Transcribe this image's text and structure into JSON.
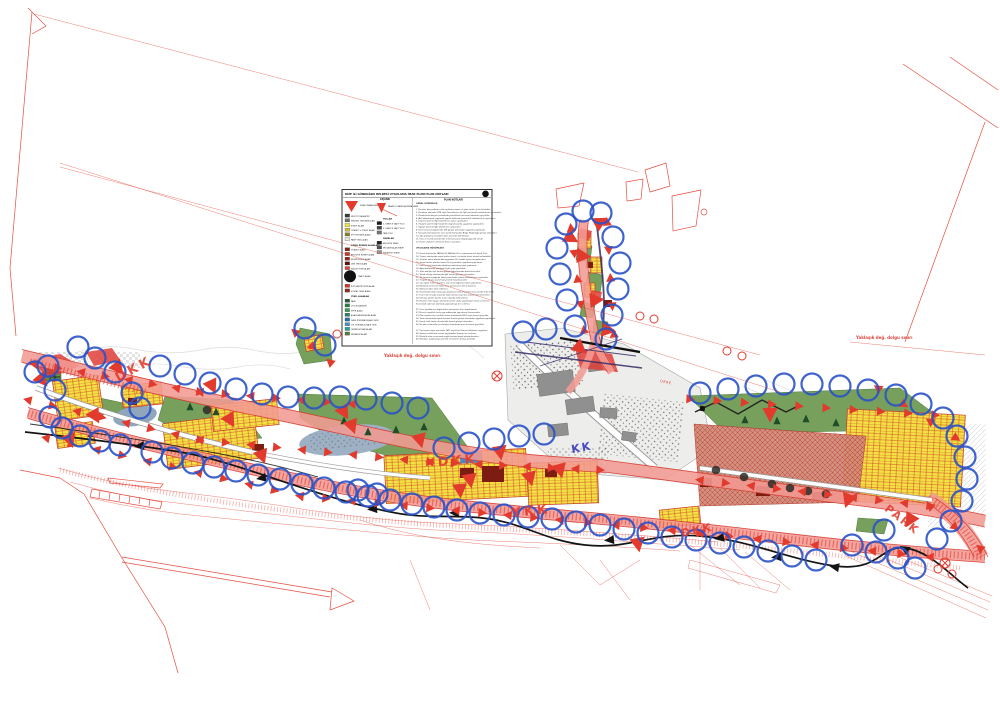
{
  "title": "RİZE İLİ GÜNDOĞDU BELDESİ UYGULAMA İMAR PLANI PLAN NOTLARI",
  "colors": {
    "boundary_red": "#e23b2e",
    "corridor_pink": "#f29a93",
    "parcel_yellow": "#f2e243",
    "park_green": "#76a05c",
    "circle_blue": "#2a52c8",
    "brick": "#cf8a79",
    "water": "#9db0c4",
    "ink": "#141414"
  },
  "legend": {
    "title": "RİZE İLİ GÜNDOĞDU BELDESİ UYGULAMA İMAR PLANI PLAN NOTLARI",
    "lejand_label": "LEJAND",
    "notes_title": "PLAN NOTLARI",
    "col1": [
      {
        "sym": "tri",
        "c": "#e23b2e",
        "t": "PLAN ONAMA SINIRI"
      },
      {
        "sym": "sw",
        "c": "#3a3a3a",
        "t": "MEVCUT KADASTRO"
      },
      {
        "sym": "sw",
        "c": "#6e6e6e",
        "t": "KENTSEL YERLEŞİK ALAN"
      },
      {
        "sym": "sw",
        "c": "#f2e243",
        "t": "KONUT ALANI"
      },
      {
        "sym": "sw",
        "c": "#cdbb3e",
        "t": "TİCARET + KONUT ALANI"
      },
      {
        "sym": "sw",
        "c": "#8a7f2f",
        "t": "KÖY YERLEŞİK ALANI"
      },
      {
        "sym": "sw",
        "c": "#e8e6da",
        "t": "PASİF YEŞİL ALAN"
      },
      {
        "sym": "hdr",
        "c": "",
        "t": "KAMU KURUM ALANLARI"
      },
      {
        "sym": "sw",
        "c": "#8c1d12",
        "t": "TİCARET ALANI"
      },
      {
        "sym": "sw",
        "c": "#c0392b",
        "t": "BELEDİYE HİZMET ALANI"
      },
      {
        "sym": "sw",
        "c": "#93271e",
        "t": "RESMİ KURUM ALANI"
      },
      {
        "sym": "sw",
        "c": "#5b1207",
        "t": "DİNİ TESİS ALANI"
      },
      {
        "sym": "sw",
        "c": "#d04a3a",
        "t": "SAĞLIK TESİS ALANI"
      },
      {
        "sym": "circle",
        "c": "#111111",
        "t": "TRAFO ALANI"
      },
      {
        "sym": "sw",
        "c": "#d3372c",
        "t": "İLKÖĞRETİM TESİS ALANI"
      },
      {
        "sym": "sw",
        "c": "#8f2a20",
        "t": "SOSYAL TESİS ALANI"
      },
      {
        "sym": "hdr",
        "c": "",
        "t": "YEŞİL ALANLAR"
      },
      {
        "sym": "sw",
        "c": "#1e5c34",
        "t": "PARK"
      },
      {
        "sym": "sw",
        "c": "#2e7d46",
        "t": "ÇOCUK BAHÇESİ"
      },
      {
        "sym": "sw",
        "c": "#3f9a58",
        "t": "SPOR ALANI"
      },
      {
        "sym": "sw",
        "c": "#2a7f71",
        "t": "AĞAÇLANDIRILACAK ALAN"
      },
      {
        "sym": "sw",
        "c": "#1f6fae",
        "t": "DERE KORUMA KUŞAĞI (DKK)"
      },
      {
        "sym": "sw",
        "c": "#4a90c4",
        "t": "YOL KORUMA KUŞAĞI (YKK)"
      },
      {
        "sym": "sw",
        "c": "#2aa198",
        "t": "TEKNİK ALTYAPI ALANI"
      },
      {
        "sym": "sw",
        "c": "#577d35",
        "t": "MEZARLIK ALANI"
      }
    ],
    "col2": [
      {
        "sym": "funnel",
        "c": "#e23b2e",
        "t": "KARAYOLU KAMULAŞTIRMA SINIRI"
      },
      {
        "sym": "hdr",
        "c": "",
        "t": "YOLLAR"
      },
      {
        "sym": "sw",
        "c": "#1a1a1a",
        "t": "1. DERECE TAŞIT YOLU"
      },
      {
        "sym": "sw",
        "c": "#4a4a4a",
        "t": "2. DERECE TAŞIT YOLU"
      },
      {
        "sym": "sw",
        "c": "#777777",
        "t": "YAYA YOLU"
      },
      {
        "sym": "hdr",
        "c": "",
        "t": "SINIRLAR"
      },
      {
        "sym": "sw",
        "c": "#222222",
        "t": "BELEDİYE SINIRI"
      },
      {
        "sym": "sw",
        "c": "#555555",
        "t": "MÜCAVİR ALAN SINIRI"
      },
      {
        "sym": "sw",
        "c": "#999999",
        "t": "KADASTRO SINIRI"
      }
    ],
    "notes": [
      "GENEL HÜKÜMLER",
      "",
      "1. Bu plan; plan paftaları, plan açıklama raporu ve plan notları ile bir bütündür.",
      "2. Planlama alanında 3194 sayılı İmar Kanunu ile ilgili yönetmelik hükümlerine uyulacaktır.",
      "3. Planda belirtilmeyen hususlarda yürürlükteki mevzuat hükümleri geçerlidir.",
      "4. Afet bölgelerinde yapılacak yapılar hakkında yönetmelik hükümlerine uyulacaktır.",
      "5. Deprem yönetmeliği hükümlerine aynen uyulacaktır.",
      "6. Otopark yönetmeliği hükümleri doğrultusunda uygulama yapılacaktır.",
      "7. Sığınak yönetmeliği hükümlerine uyulacaktır.",
      "8. Dere koruma kuşaklarında DSİ görüşü alınmadan uygulama yapılamaz.",
      "9. Karayolu kamulaştırma sınırı içinde Karayolları Bölge Müdürlüğü görüşü alınacaktır.",
      "10. Yapı yaklaşma mesafeleri plan üzerinde belirtilmiştir.",
      "11. İfraz ve tevhid işlemlerinde minimum parsel büyüklüğü 250 m2'dir.",
      "12. Parsel cepheleri minimum 8.00 m olacaktır.",
      "",
      "UYGULAMA HÜKÜMLERİ",
      "",
      "13. Konut alanlarında TAKS=0.30 KAKS=0.90 ve maksimum kat adedi 3'tür.",
      "14. Ticaret alanlarında zemin katlar ticaret, üst katlar konut olarak kullanılabilir.",
      "15. Gelişme konut alanlarında uygulama 18. madde uyarınca yapılacaktır.",
      "16. Sosyal donatı alanları kamu eline geçmeden uygulama yapılamaz.",
      "17. Park ve yeşil alanlarda sökülemez-takılamaz yapı yapılamaz.",
      "18. Ağaçlandırılacak alanlarda hiçbir yapı yapılamaz.",
      "19. Trafo alanları ilgili kurum görüşü doğrultusunda düzenlenecektir.",
      "20. Teknik altyapı alanlarında ilgili kurum görüşleri alınacaktır.",
      "21. Yol koruma kuşağında kalan parsellerde çekme mesafelerine uyulacaktır.",
      "22. Otopark ihtiyacı parsel bünyesinde karşılanacaktır.",
      "23. Çatı eğimi %33'ü geçemez. Çatı arası bağımsız bölüm yapılamaz.",
      "24. Binalarda zemin kat taban kotu yol kotunun altına düşemez.",
      "25. Bodrum katlar iskan edilemez.",
      "26. Parsellerde birden fazla yapı yapılması halinde yapılar arası mesafe 6.00 m'dir.",
      "27. İmar hattı ile yapı arasında kalan alanlar yeşil alan olarak düzenlenecektir.",
      "28. Kamuya ayrılan alanlar amacı dışında kullanılamaz.",
      "29. Heyelan riski taşıyan alanlarda zemin etüdü yapılmadan ruhsat verilemez.",
      "30. Jeolojik sakıncalı alanlarda yapılaşmaya izin verilmez.",
      "",
      "31. Dere yataklarının doğal halleri korunacak, üzeri kapatılamaz.",
      "32. Mevcut teşekkül etmiş yapı adalarında yapı düzeni korunacaktır.",
      "33. Plan onama sınırı içindeki orman alanlarında 6831 sayılı kanun geçerlidir.",
      "34. Tarım alanlarında toprak koruma kurulu görüşü alınmadan uygulama yapılamaz.",
      "35. Enerji nakil hatları altında ilgili kurum görüşü alınacaktır.",
      "36. Bu plan notlarında yer almayan hususlarda meri mevzuat geçerlidir.",
      "",
      "37. Kıyı kenar çizgisi içerisinde 3621 sayılı Kıyı Kanunu hükümleri uygulanır.",
      "38. Sanayi tesislerinde arıtma yapılmadan deşarja izin verilmez.",
      "39. Mezarlık alanı çevresinde sağlık koruma bandı oluşturulacaktır.",
      "40. Belediye, uygulamaya yönelik ek kararlar almaya yetkilidir."
    ]
  },
  "map": {
    "labels": [
      {
        "t": "DKK",
        "x": 118,
        "y": 382,
        "r": -28,
        "s": 13,
        "c": "#e23b2e",
        "ls": 3,
        "b": 1
      },
      {
        "t": "DKK",
        "x": 438,
        "y": 466,
        "r": -4,
        "s": 13,
        "c": "#e23b2e",
        "ls": 3,
        "b": 1
      },
      {
        "t": "DKK",
        "x": 682,
        "y": 537,
        "r": -12,
        "s": 11,
        "c": "#e23b2e",
        "ls": 2,
        "b": 1
      },
      {
        "t": "YKK",
        "x": 512,
        "y": 517,
        "r": -6,
        "s": 13,
        "c": "#e23b2e",
        "ls": 3,
        "b": 1
      },
      {
        "t": "KK",
        "x": 572,
        "y": 453,
        "r": -10,
        "s": 11,
        "c": "#3333bb",
        "ls": 2,
        "b": 1
      },
      {
        "t": "PARK",
        "x": 884,
        "y": 510,
        "r": 38,
        "s": 11,
        "c": "#e23b2e",
        "ls": 2,
        "b": 1
      },
      {
        "t": "Yaklaşık değ. dolgu sınırı",
        "x": 384,
        "y": 357,
        "r": 0,
        "s": 4,
        "c": "#d42a20",
        "ls": 0,
        "b": 1
      },
      {
        "t": "Yaklaşık değ. dolgu sınırı",
        "x": 856,
        "y": 339,
        "r": 0,
        "s": 4,
        "c": "#d42a20",
        "ls": 0,
        "b": 1
      },
      {
        "t": "DERE",
        "x": 660,
        "y": 382,
        "r": 12,
        "s": 3.5,
        "c": "#d42a20",
        "ls": 0.5,
        "b": 0
      }
    ],
    "blue_circles": [
      [
        78,
        347
      ],
      [
        48,
        366
      ],
      [
        95,
        358
      ],
      [
        35,
        372
      ],
      [
        55,
        390
      ],
      [
        50,
        417
      ],
      [
        62,
        428
      ],
      [
        80,
        436
      ],
      [
        100,
        441
      ],
      [
        120,
        445
      ],
      [
        132,
        393
      ],
      [
        115,
        372
      ],
      [
        140,
        408
      ],
      [
        152,
        452
      ],
      [
        172,
        458
      ],
      [
        193,
        463
      ],
      [
        214,
        467
      ],
      [
        236,
        471
      ],
      [
        258,
        475
      ],
      [
        280,
        479
      ],
      [
        302,
        484
      ],
      [
        324,
        488
      ],
      [
        346,
        492
      ],
      [
        368,
        496
      ],
      [
        390,
        500
      ],
      [
        412,
        504
      ],
      [
        434,
        507
      ],
      [
        457,
        510
      ],
      [
        480,
        513
      ],
      [
        504,
        515
      ],
      [
        528,
        517
      ],
      [
        552,
        519
      ],
      [
        576,
        522
      ],
      [
        600,
        525
      ],
      [
        624,
        529
      ],
      [
        648,
        533
      ],
      [
        672,
        537
      ],
      [
        696,
        540
      ],
      [
        160,
        366
      ],
      [
        185,
        374
      ],
      [
        210,
        383
      ],
      [
        236,
        389
      ],
      [
        262,
        394
      ],
      [
        288,
        397
      ],
      [
        314,
        398
      ],
      [
        340,
        397
      ],
      [
        366,
        399
      ],
      [
        392,
        403
      ],
      [
        418,
        408
      ],
      [
        444,
        448
      ],
      [
        469,
        443
      ],
      [
        494,
        439
      ],
      [
        519,
        436
      ],
      [
        544,
        434
      ],
      [
        523,
        332
      ],
      [
        546,
        329
      ],
      [
        358,
        490
      ],
      [
        377,
        494
      ],
      [
        305,
        328
      ],
      [
        325,
        345
      ],
      [
        566,
        224
      ],
      [
        557,
        248
      ],
      [
        560,
        274
      ],
      [
        567,
        300
      ],
      [
        575,
        326
      ],
      [
        601,
        213
      ],
      [
        613,
        237
      ],
      [
        620,
        263
      ],
      [
        618,
        289
      ],
      [
        612,
        315
      ],
      [
        606,
        339
      ],
      [
        583,
        211
      ],
      [
        700,
        393
      ],
      [
        728,
        389
      ],
      [
        756,
        386
      ],
      [
        784,
        384
      ],
      [
        812,
        384
      ],
      [
        840,
        386
      ],
      [
        868,
        390
      ],
      [
        896,
        395
      ],
      [
        921,
        404
      ],
      [
        943,
        418
      ],
      [
        957,
        436
      ],
      [
        965,
        457
      ],
      [
        967,
        479
      ],
      [
        962,
        501
      ],
      [
        951,
        521
      ],
      [
        937,
        539
      ],
      [
        852,
        545
      ],
      [
        876,
        552
      ],
      [
        898,
        558
      ],
      [
        915,
        568
      ],
      [
        884,
        530
      ],
      [
        720,
        543
      ],
      [
        744,
        547
      ],
      [
        768,
        551
      ],
      [
        792,
        556
      ],
      [
        816,
        560
      ]
    ],
    "triangle_chains": [
      {
        "f": [
          34,
          364
        ],
        "t": [
          200,
          392
        ],
        "n": 8,
        "s": "a"
      },
      {
        "f": [
          200,
          392
        ],
        "t": [
          352,
          404
        ],
        "n": 7,
        "s": "a"
      },
      {
        "f": [
          28,
          400
        ],
        "t": [
          200,
          440
        ],
        "n": 8,
        "s": "a"
      },
      {
        "f": [
          200,
          440
        ],
        "t": [
          430,
          462
        ],
        "n": 10,
        "s": "a"
      },
      {
        "f": [
          430,
          462
        ],
        "t": [
          600,
          470
        ],
        "n": 8,
        "s": "a"
      },
      {
        "f": [
          46,
          438
        ],
        "t": [
          300,
          496
        ],
        "n": 11,
        "s": "a"
      },
      {
        "f": [
          300,
          496
        ],
        "t": [
          560,
          520
        ],
        "n": 11,
        "s": "a"
      },
      {
        "f": [
          560,
          520
        ],
        "t": [
          700,
          533
        ],
        "n": 6,
        "s": "a"
      },
      {
        "f": [
          700,
          533
        ],
        "t": [
          930,
          557
        ],
        "n": 9,
        "s": "a"
      },
      {
        "f": [
          690,
          399
        ],
        "t": [
          935,
          415
        ],
        "n": 10,
        "s": 1
      },
      {
        "f": [
          700,
          480
        ],
        "t": [
          930,
          506
        ],
        "n": 10,
        "s": "a"
      },
      {
        "f": [
          930,
          506
        ],
        "t": [
          980,
          548
        ],
        "n": 3,
        "s": "a"
      },
      {
        "f": [
          571,
          228
        ],
        "t": [
          584,
          330
        ],
        "n": 5,
        "s": "a"
      },
      {
        "f": [
          607,
          222
        ],
        "t": [
          614,
          334
        ],
        "n": 5,
        "s": "a"
      },
      {
        "f": [
          878,
          388
        ],
        "t": [
          956,
          438
        ],
        "n": 4,
        "s": "a"
      },
      {
        "f": [
          295,
          332
        ],
        "t": [
          330,
          362
        ],
        "n": 3,
        "s": "a"
      }
    ],
    "big_triangles": [
      [
        212,
        386,
        155
      ],
      [
        344,
        412,
        150
      ],
      [
        352,
        426,
        160
      ],
      [
        470,
        480,
        170
      ],
      [
        583,
        256,
        95
      ],
      [
        596,
        300,
        85
      ],
      [
        460,
        490,
        175
      ],
      [
        530,
        478,
        165
      ],
      [
        638,
        544,
        170
      ],
      [
        118,
        368,
        140
      ],
      [
        95,
        416,
        150
      ],
      [
        262,
        456,
        160
      ],
      [
        770,
        414,
        180
      ],
      [
        848,
        500,
        200
      ],
      [
        600,
        222,
        60
      ],
      [
        571,
        238,
        120
      ],
      [
        608,
        330,
        100
      ],
      [
        580,
        348,
        130
      ],
      [
        910,
        520,
        210
      ],
      [
        42,
        380,
        140
      ],
      [
        70,
        440,
        160
      ],
      [
        230,
        420,
        150
      ],
      [
        420,
        440,
        165
      ],
      [
        500,
        452,
        170
      ],
      [
        560,
        470,
        165
      ]
    ],
    "ring_pairs": [
      [
        337,
        334
      ],
      [
        350,
        337
      ],
      [
        640,
        316
      ],
      [
        654,
        319
      ],
      [
        727,
        351
      ],
      [
        742,
        356
      ],
      [
        938,
        569
      ],
      [
        952,
        574
      ]
    ],
    "cross_circles": [
      [
        430,
        271
      ],
      [
        497,
        376
      ],
      [
        945,
        563
      ]
    ],
    "stream_arrows": [
      [
        140,
        446,
        -95
      ],
      [
        262,
        478,
        -100
      ],
      [
        373,
        509,
        -95
      ],
      [
        455,
        513,
        -88
      ],
      [
        610,
        540,
        -95
      ],
      [
        720,
        538,
        -100
      ],
      [
        777,
        557,
        -95
      ],
      [
        835,
        567,
        -80
      ],
      [
        905,
        549,
        -60
      ]
    ],
    "conifers": [
      [
        368,
        432
      ],
      [
        396,
        430
      ],
      [
        424,
        427
      ],
      [
        344,
        421
      ],
      [
        745,
        420
      ],
      [
        777,
        421
      ],
      [
        806,
        419
      ],
      [
        216,
        412
      ],
      [
        190,
        407
      ],
      [
        836,
        423
      ]
    ],
    "round_trees": [
      [
        716,
        470
      ],
      [
        744,
        477
      ],
      [
        772,
        484
      ],
      [
        790,
        488
      ],
      [
        808,
        491
      ],
      [
        826,
        494
      ],
      [
        207,
        410
      ]
    ]
  }
}
